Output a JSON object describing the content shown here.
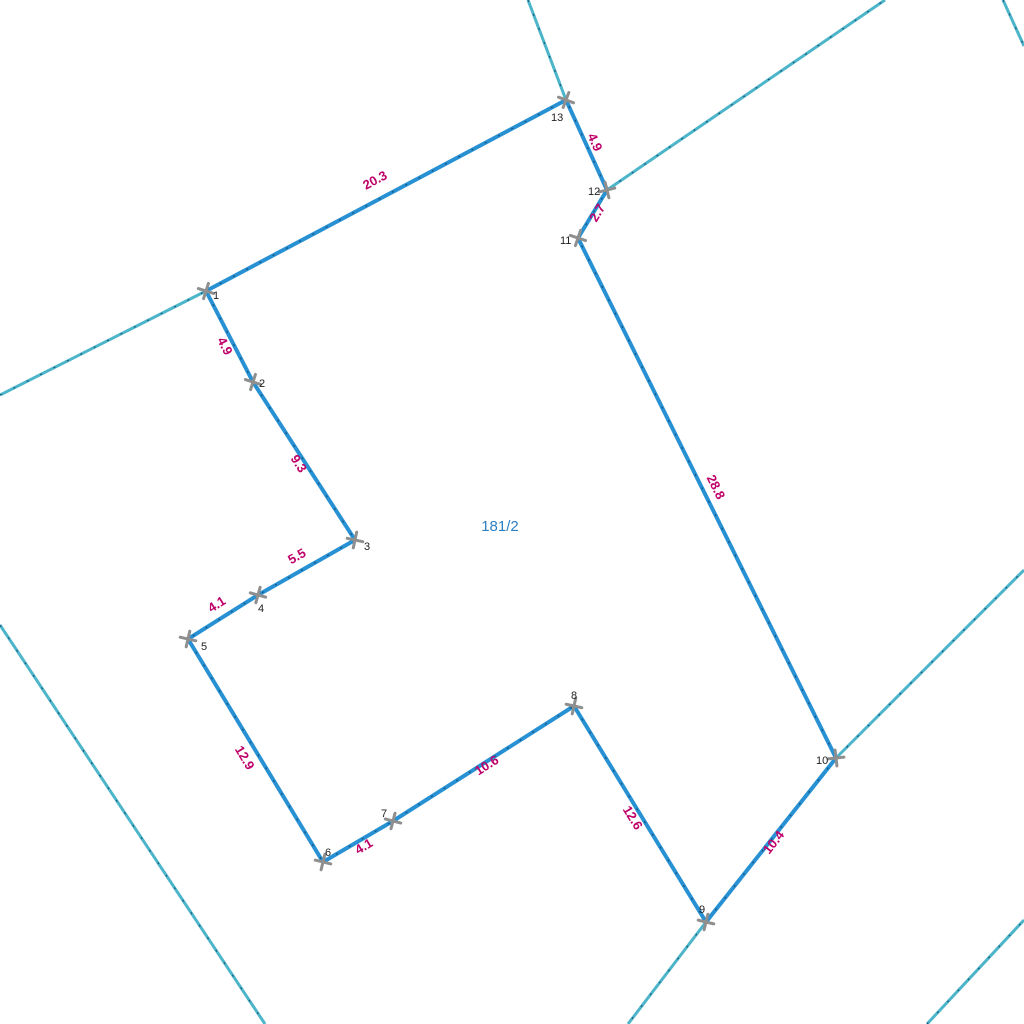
{
  "map": {
    "parcel_label": {
      "text": "181/2",
      "x": 500,
      "y": 531
    },
    "colors": {
      "parcel_edge": "#2791d4",
      "neighbor_boundary": "#4cb5ca",
      "dash_overlay": "#14476b",
      "measurement_text": "#bf0069",
      "vertex_marker": "#8f8f8f",
      "vertex_text": "#1f1f1f",
      "parcel_text": "#2d7fc4"
    },
    "vertices": [
      {
        "id": "1",
        "x": 206,
        "y": 291,
        "lx": 213,
        "ly": 299
      },
      {
        "id": "2",
        "x": 253,
        "y": 382,
        "lx": 259,
        "ly": 387
      },
      {
        "id": "3",
        "x": 355,
        "y": 540,
        "lx": 364,
        "ly": 550
      },
      {
        "id": "4",
        "x": 258,
        "y": 595,
        "lx": 258,
        "ly": 612
      },
      {
        "id": "5",
        "x": 188,
        "y": 639,
        "lx": 201,
        "ly": 650
      },
      {
        "id": "6",
        "x": 323,
        "y": 862,
        "lx": 325,
        "ly": 856
      },
      {
        "id": "7",
        "x": 393,
        "y": 821,
        "lx": 381,
        "ly": 817
      },
      {
        "id": "8",
        "x": 574,
        "y": 706,
        "lx": 571,
        "ly": 699
      },
      {
        "id": "9",
        "x": 706,
        "y": 922,
        "lx": 699,
        "ly": 913
      },
      {
        "id": "10",
        "x": 836,
        "y": 758,
        "lx": 816,
        "ly": 764
      },
      {
        "id": "11",
        "x": 578,
        "y": 238,
        "lx": 560,
        "ly": 244
      },
      {
        "id": "12",
        "x": 607,
        "y": 190,
        "lx": 588,
        "ly": 195
      },
      {
        "id": "13",
        "x": 566,
        "y": 100,
        "lx": 551,
        "ly": 121
      }
    ],
    "edges": [
      {
        "from": "1",
        "to": "2",
        "length": "4.9",
        "label_x": 221,
        "label_y": 348,
        "label_angle": 62.7
      },
      {
        "from": "2",
        "to": "3",
        "length": "9.3",
        "label_x": 295,
        "label_y": 466,
        "label_angle": 57.2
      },
      {
        "from": "3",
        "to": "4",
        "length": "5.5",
        "label_x": 299,
        "label_y": 560,
        "label_angle": -29.6
      },
      {
        "from": "4",
        "to": "5",
        "length": "4.1",
        "label_x": 219,
        "label_y": 608,
        "label_angle": -32.2
      },
      {
        "from": "5",
        "to": "6",
        "length": "12.9",
        "label_x": 241,
        "label_y": 760,
        "label_angle": 58.8
      },
      {
        "from": "6",
        "to": "7",
        "length": "4.1",
        "label_x": 366,
        "label_y": 850,
        "label_angle": -30.4
      },
      {
        "from": "7",
        "to": "8",
        "length": "10.6",
        "label_x": 489,
        "label_y": 769,
        "label_angle": -32.4
      },
      {
        "from": "8",
        "to": "9",
        "length": "12.6",
        "label_x": 629,
        "label_y": 820,
        "label_angle": 58.6
      },
      {
        "from": "9",
        "to": "10",
        "length": "10.4",
        "label_x": 777,
        "label_y": 845,
        "label_angle": -51.6
      },
      {
        "from": "10",
        "to": "11",
        "length": "28.8",
        "label_x": 712,
        "label_y": 489,
        "label_angle": 63.6
      },
      {
        "from": "11",
        "to": "12",
        "length": "2.7",
        "label_x": 601,
        "label_y": 215,
        "label_angle": -58.9
      },
      {
        "from": "12",
        "to": "13",
        "length": "4.9",
        "label_x": 591,
        "label_y": 144,
        "label_angle": 65.5
      },
      {
        "from": "13",
        "to": "1",
        "length": "20.3",
        "label_x": 377,
        "label_y": 184,
        "label_angle": -28.0
      }
    ],
    "neighbor_lines": [
      {
        "x1": 0,
        "y1": 395,
        "x2": 206,
        "y2": 291
      },
      {
        "x1": 528,
        "y1": 0,
        "x2": 566,
        "y2": 100
      },
      {
        "x1": 607,
        "y1": 190,
        "x2": 885,
        "y2": 0
      },
      {
        "x1": 1003,
        "y1": 0,
        "x2": 1024,
        "y2": 46
      },
      {
        "x1": 0,
        "y1": 625,
        "x2": 265,
        "y2": 1024
      },
      {
        "x1": 706,
        "y1": 922,
        "x2": 628,
        "y2": 1024
      },
      {
        "x1": 836,
        "y1": 758,
        "x2": 1024,
        "y2": 570
      },
      {
        "x1": 927,
        "y1": 1024,
        "x2": 1024,
        "y2": 920
      }
    ]
  }
}
